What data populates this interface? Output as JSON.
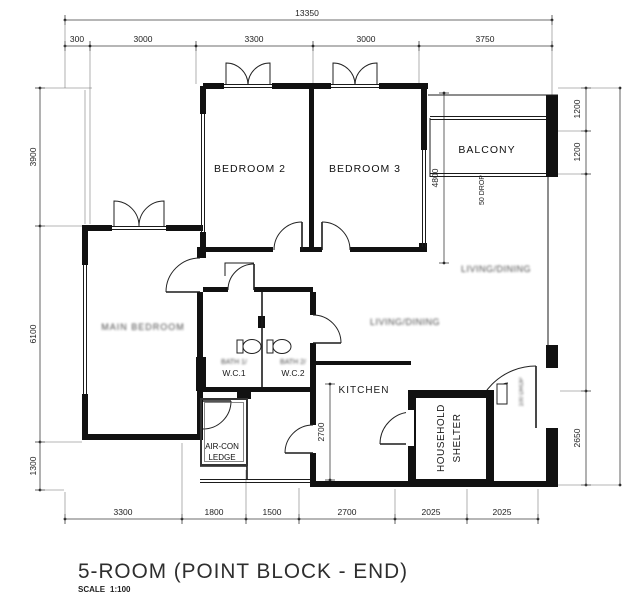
{
  "title": {
    "name": "5-ROOM (POINT BLOCK - END)",
    "scale_label": "SCALE",
    "scale_value": "1:100"
  },
  "rooms": {
    "bedroom2": "BEDROOM 2",
    "bedroom3": "BEDROOM 3",
    "balcony": "BALCONY",
    "main_bedroom": "MAIN BEDROOM",
    "living_dining_upper": "LIVING/DINING",
    "living_dining_lower": "LIVING/DINING",
    "bath1_line1": "BATH 1/",
    "bath1_line2": "W.C.1",
    "bath2_line1": "BATH 2/",
    "bath2_line2": "W.C.2",
    "kitchen": "KITCHEN",
    "aircon_line1": "AIR-CON",
    "aircon_line2": "LEDGE",
    "shelter_line1": "HOUSEHOLD",
    "shelter_line2": "SHELTER"
  },
  "dimensions": {
    "top_total": "13350",
    "top": [
      "300",
      "3000",
      "3300",
      "3000",
      "3750"
    ],
    "left": [
      "3900",
      "6100",
      "1300"
    ],
    "right": [
      "1200",
      "1200",
      "2650"
    ],
    "bottom": [
      "3300",
      "1800",
      "1500",
      "2700",
      "2025",
      "2025"
    ],
    "balcony_depth": "4800",
    "kitchen_depth": "2700"
  },
  "annotations": {
    "drop50": "50 DROP",
    "drop100": "100 DROP"
  }
}
